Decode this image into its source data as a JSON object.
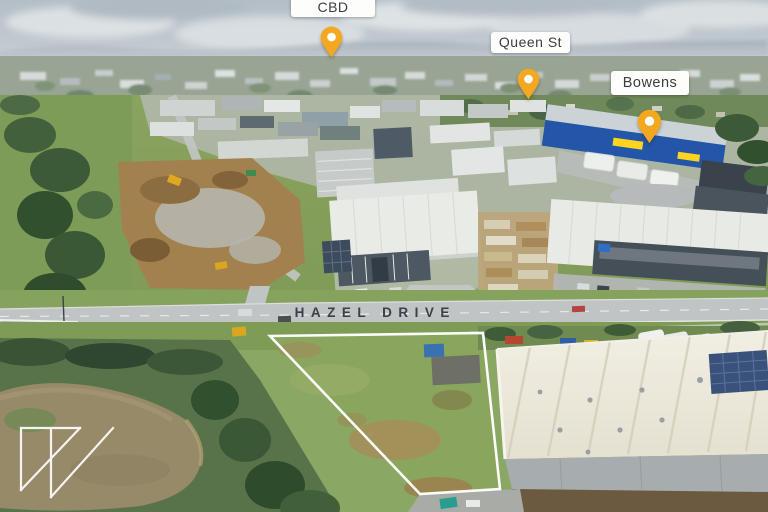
{
  "theme": {
    "pin-color": "#F3A81F",
    "pin-hole": "#FFFFFF",
    "label-bg": "#FDFDFB",
    "label-text": "#3A3E41",
    "boundary-color": "#FFFFFF",
    "road-label-color": "#3B4146",
    "logo-color": "#FFFFFF"
  },
  "annotations": {
    "street_label": "HAZEL DRIVE",
    "pins": [
      {
        "id": "warragul-cbd",
        "label_lines": [
          "Warragul",
          "CBD"
        ]
      },
      {
        "id": "queen-st",
        "label_lines": [
          "Queen St"
        ]
      },
      {
        "id": "bowens",
        "label_lines": [
          "Bowens"
        ]
      }
    ]
  },
  "scene": {
    "type": "aerial-drone-photograph",
    "subject": "Vacant land parcel outlined in white beside Hazel Drive, with pond, industrial warehouses and township beyond under a hazy sky",
    "tagged_landmarks": [
      "Warragul CBD",
      "Queen St",
      "Bowens"
    ]
  },
  "watermark": {
    "description": "white outlined double-triangle agency mark"
  }
}
